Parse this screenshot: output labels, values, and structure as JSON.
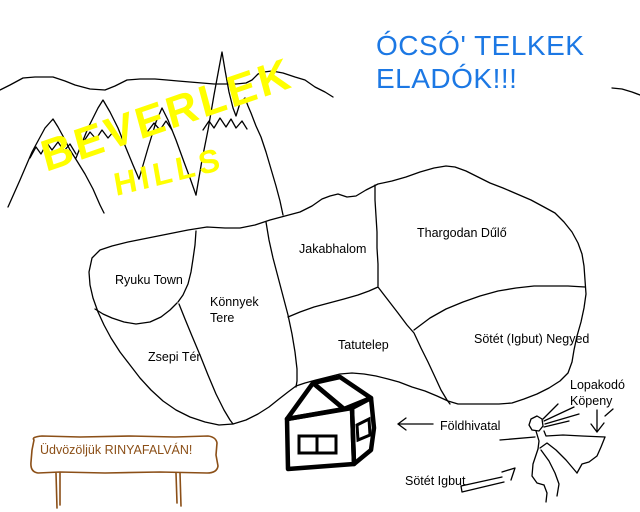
{
  "headline": {
    "line1": "ÓCSÓ' TELKEK",
    "line2": "ELADÓK!!!"
  },
  "hills": {
    "line1": "BEVERLEK",
    "line2": "HILLS"
  },
  "regions": [
    {
      "label": "Ryuku Town"
    },
    {
      "label": "Könnyek",
      "label2": "Tere"
    },
    {
      "label": "Zsepi Tér"
    },
    {
      "label": "Jakabhalom"
    },
    {
      "label": "Thargodan Dűlő"
    },
    {
      "label": "Tatutelep"
    },
    {
      "label": "Sötét (Igbut) Negyed"
    }
  ],
  "landmarks": {
    "land_office": "Földhivatal",
    "dark_igbut": "Sötét Igbut",
    "cloak_line1": "Lopakodó",
    "cloak_line2": "Köpeny"
  },
  "sign": {
    "text": "Üdvözöljük RINYAFALVÁN!"
  },
  "colors": {
    "headline_blue": "#1c78e4",
    "hills_yellow": "#ffff00",
    "sign_brown": "#8b4f17",
    "ink": "#000000",
    "house_front": "#f1986b",
    "house_side": "#ee8c52",
    "house_roof": "#e91414",
    "house_gable": "#f6f2a2",
    "window_white": "#ffffff"
  }
}
